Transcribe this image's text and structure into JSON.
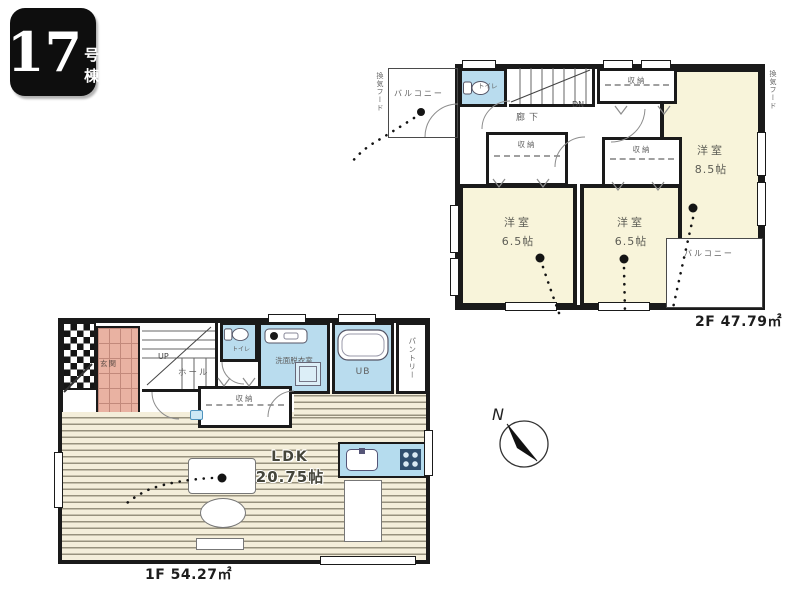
{
  "badge": {
    "number": "17",
    "suffix": "号棟"
  },
  "floor2": {
    "balcony_top": "バルコニー",
    "toilet": "トイレ",
    "stairs_dn": "DN",
    "hallway": "廊下",
    "closet_top": "収納",
    "closet_a": "収納",
    "closet_b": "収納",
    "room_main": {
      "name": "洋室",
      "size": "8.5帖"
    },
    "room_a": {
      "name": "洋室",
      "size": "6.5帖"
    },
    "room_b": {
      "name": "洋室",
      "size": "6.5帖"
    },
    "balcony_bottom": "バルコニー",
    "vent_left": "換気フード",
    "vent_right": "換気フード",
    "area_label": "2F 47.79㎡"
  },
  "floor1": {
    "entrance": "玄関",
    "stairs_up": "UP",
    "hall": "ホール",
    "toilet": "トイレ",
    "washroom": "洗面脱衣室",
    "bath": "UB",
    "pantry": "パントリー",
    "closet": "収納",
    "ldk": {
      "name": "LDK",
      "size": "20.75帖"
    },
    "area_label": "1F 54.27㎡"
  },
  "compass": {
    "north": "N"
  },
  "colors": {
    "wall": "#1a1a1a",
    "room_fill": "#f8f4da",
    "wet_area_fill": "#b9dcee",
    "entrance_tile": "#e9b2a2",
    "kitchen_counter": "#b5dcee",
    "wood_floor": "#f4eeda"
  }
}
